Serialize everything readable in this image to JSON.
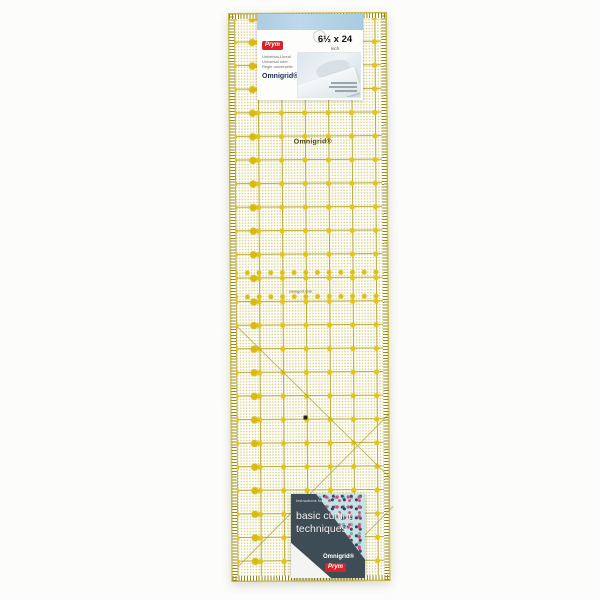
{
  "product": {
    "description": "Omnigrid universal quilting ruler product photo",
    "top_label": {
      "prym_logo": "Prym",
      "subtitle_lines": [
        "Universal-Lineal",
        "Universal ruler",
        "Règle universelle"
      ],
      "brand": "Omnigrid®",
      "size": "6½ x 24",
      "unit": "inch"
    },
    "ruler_print": {
      "brand": "Omnigrid®",
      "website": "omnigrid.com"
    },
    "bottom_label": {
      "small_text": "Instructions for",
      "title_line1": "basic cutting",
      "title_line2": "techniques",
      "brand": "Omnigrid®",
      "prym_logo": "Prym"
    },
    "colors": {
      "grid_olive": "#b2a42c",
      "dot_yellow": "#e4c414",
      "label_blue_band": "#b5d2e6",
      "bottom_label_slate": "#3e4c55",
      "prym_red": "#d8232a"
    }
  }
}
